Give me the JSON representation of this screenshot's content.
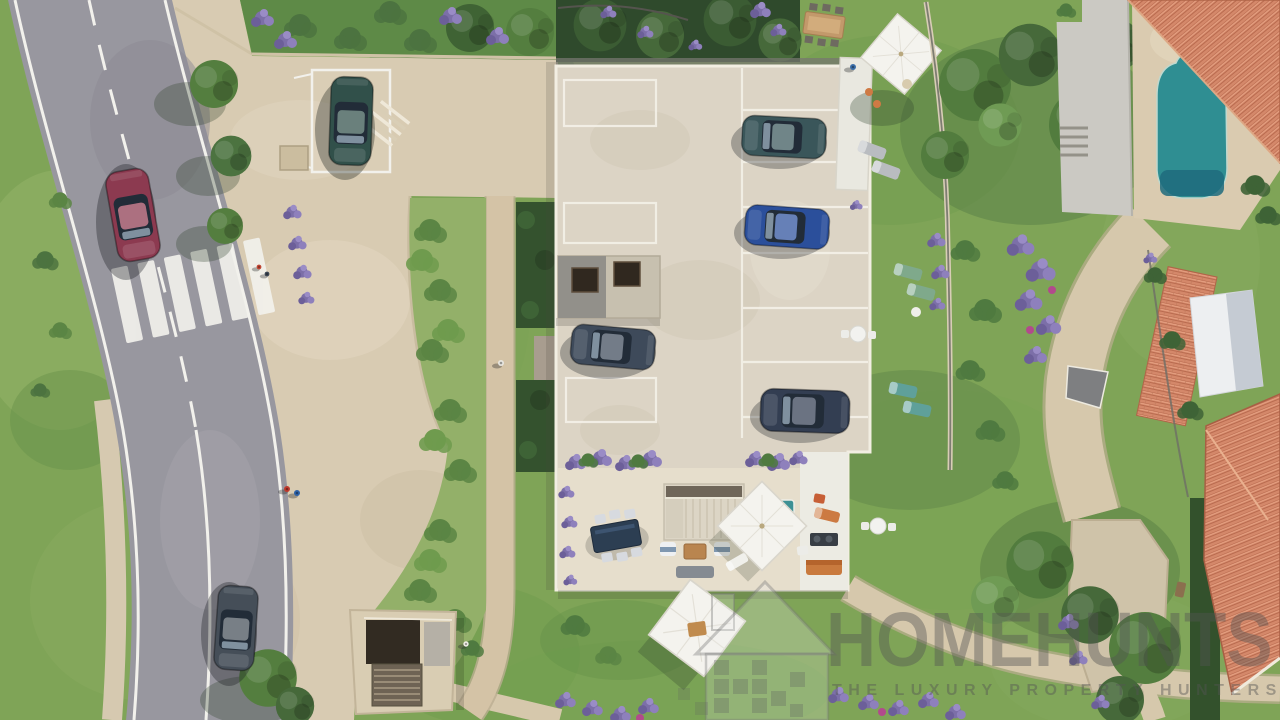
{
  "meta": {
    "kind": "aerial-3d-architectural-render",
    "subject": "Bird's-eye view of a residential development with curved road, rooftop parking deck, landscaped gardens, terrace and neighbouring pool"
  },
  "watermark": {
    "brand": "HOMEHUNTS",
    "tagline": "THE LUXURY PROPERTY HUNTERS",
    "logo": "pixel-house-icon"
  },
  "palette": {
    "grass": "#7FA457",
    "grass_dark": "#4C7340",
    "road": "#98979F",
    "pavement": "#D8CBB2",
    "deck": "#DCD4C5",
    "terrace": "#E6DECC",
    "pool": "#2F8E92",
    "roof_tile": "#D4886A",
    "lavender": "#7C6FA8",
    "marking_white": "#F2F1EC",
    "hedge": "#34522E"
  },
  "scene": {
    "road": {
      "name": "curved-road",
      "features": [
        "solid edge lines",
        "dashed centre line",
        "zebra crossing"
      ]
    },
    "vehicles": [
      {
        "name": "red-car-on-road",
        "color": "#8C3A50"
      },
      {
        "name": "grey-car-on-road",
        "color": "#454E58"
      },
      {
        "name": "green-suv-parked-driveway",
        "color": "#31504A"
      },
      {
        "name": "teal-car-parking-deck",
        "color": "#3A565A"
      },
      {
        "name": "blue-car-parking-deck",
        "color": "#2B4F9B"
      },
      {
        "name": "slate-car-parking-deck",
        "color": "#3E4A5A"
      },
      {
        "name": "navy-car-parking-deck",
        "color": "#333E52"
      }
    ],
    "building": {
      "name": "apartment-building-with-rooftop-parking",
      "skylights": 2,
      "marked_spaces": 10
    },
    "terrace_items": [
      "dining table",
      "switchback stair",
      "lounge sofas",
      "square parasol",
      "spa tub",
      "barbecue",
      "orange loungers"
    ],
    "amenities": [
      "swimming pool",
      "sun loungers",
      "garden parasols",
      "bistro tables"
    ],
    "landscape": [
      "lawns",
      "lavender beds",
      "olive trees",
      "curved footpaths",
      "stone plaza",
      "basement stair entrance"
    ],
    "people_count": 6,
    "neighbouring_roofs": 3
  }
}
